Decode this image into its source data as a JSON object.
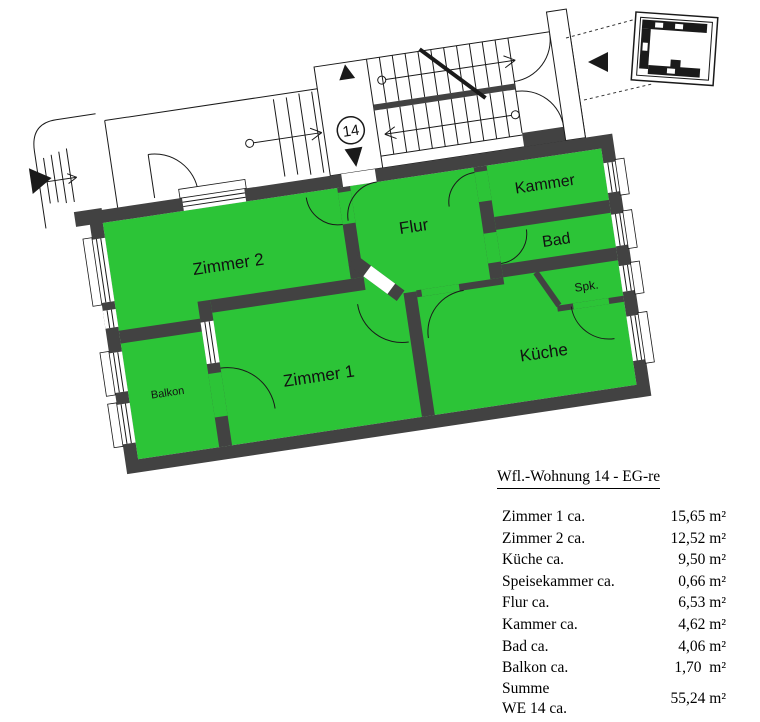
{
  "plan": {
    "unit_badge": "14",
    "colors": {
      "room_fill": "#2cc437",
      "wall": "#424242",
      "line": "#1a1a1a"
    },
    "rooms": [
      {
        "id": "zimmer2",
        "label": "Zimmer 2"
      },
      {
        "id": "zimmer1",
        "label": "Zimmer 1"
      },
      {
        "id": "flur",
        "label": "Flur"
      },
      {
        "id": "kammer",
        "label": "Kammer"
      },
      {
        "id": "bad",
        "label": "Bad"
      },
      {
        "id": "spk",
        "label": "Spk."
      },
      {
        "id": "kueche",
        "label": "Küche"
      },
      {
        "id": "balkon",
        "label": "Balkon"
      }
    ]
  },
  "table": {
    "title": "Wfl.-Wohnung 14 - EG-re",
    "rows": [
      {
        "label": "Zimmer 1 ca.",
        "value": "15,65 m²"
      },
      {
        "label": "Zimmer 2 ca.",
        "value": "12,52 m²"
      },
      {
        "label": "Küche ca.",
        "value": "9,50 m²"
      },
      {
        "label": "Speisekammer ca.",
        "value": "0,66 m²"
      },
      {
        "label": "Flur ca.",
        "value": "6,53 m²"
      },
      {
        "label": "Kammer ca.",
        "value": "4,62 m²"
      },
      {
        "label": "Bad ca.",
        "value": "4,06 m²"
      },
      {
        "label": "Balkon ca.",
        "value": "1,70  m²"
      }
    ],
    "sum_row": {
      "label_line1": "Summe",
      "label_line2": "WE 14 ca.",
      "value": "55,24 m²"
    }
  }
}
